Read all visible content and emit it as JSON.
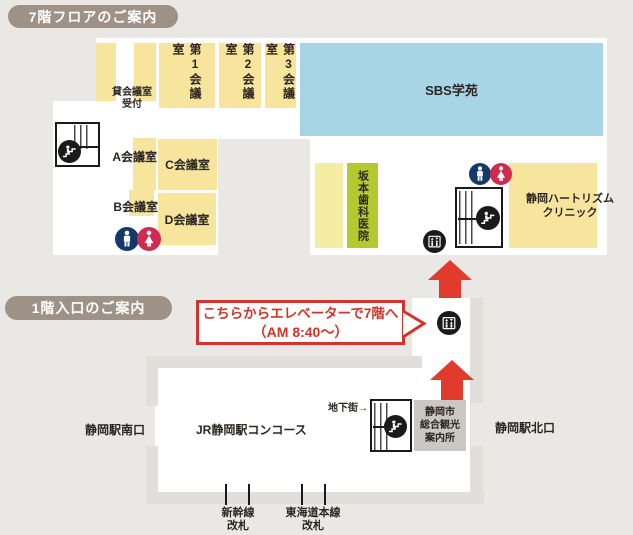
{
  "sections": {
    "f7_title": "7階フロアのご案内",
    "f1_title": "1階入口のご案内"
  },
  "f7": {
    "meeting1": "第1会議室",
    "meeting2": "第2会議室",
    "meeting3": "第3会議室",
    "sbs": "SBS学苑",
    "rental_line1": "貸会議室",
    "rental_line2": "受付",
    "room_a": "A会議室",
    "room_b": "B会議室",
    "room_c": "C会議室",
    "room_d": "D会議室",
    "sakamoto": "坂本歯科医院",
    "clinic_line1": "静岡ハートリズム",
    "clinic_line2": "クリニック"
  },
  "f1": {
    "callout_line1": "こちらからエレベーターで7階へ",
    "callout_line2": "（AM 8:40～）",
    "south_exit": "静岡駅南口",
    "concourse": "JR静岡駅コンコース",
    "underground": "地下街→",
    "info_line1": "静岡市",
    "info_line2": "総合観光",
    "info_line3": "案内所",
    "north_exit": "静岡駅北口",
    "gate1_line1": "新幹線",
    "gate1_line2": "改札",
    "gate2_line1": "東海道本線",
    "gate2_line2": "改札"
  },
  "icons": {
    "escalator": "escalator-icon",
    "elevator": "elevator-icon",
    "restroom_male": "male-restroom-icon",
    "restroom_female": "female-restroom-icon",
    "up_arrow": "up-arrow"
  },
  "colors": {
    "page_bg": "#eae8e4",
    "badge": "#9e9286",
    "room_yellow": "#f8e59d",
    "sbs_blue": "#a8d5e6",
    "dental_green": "#b2c930",
    "accent_red": "#e23b2e",
    "callout_red": "#d2342b",
    "male_navy": "#15386b",
    "female_crimson": "#d02a50",
    "info_gray": "#cbc7c2",
    "wall_gray": "#e2ded9",
    "icon_black": "#1a1a1a"
  }
}
